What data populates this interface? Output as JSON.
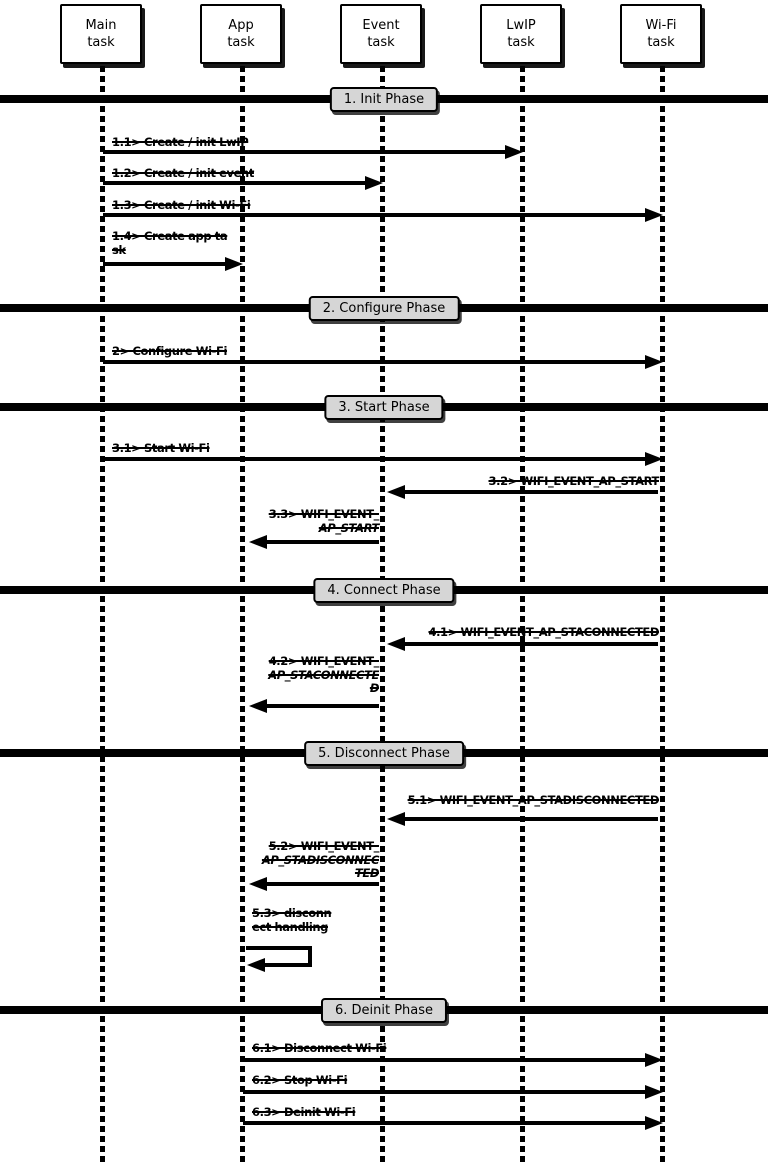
{
  "actors": [
    {
      "line1": "Main",
      "line2": "task"
    },
    {
      "line1": "App",
      "line2": "task"
    },
    {
      "line1": "Event",
      "line2": "task"
    },
    {
      "line1": "LwIP",
      "line2": "task"
    },
    {
      "line1": "Wi-Fi",
      "line2": "task"
    }
  ],
  "phases": [
    {
      "label": "1. Init Phase"
    },
    {
      "label": "2. Configure Phase"
    },
    {
      "label": "3. Start Phase"
    },
    {
      "label": "4. Connect Phase"
    },
    {
      "label": "5. Disconnect Phase"
    },
    {
      "label": "6. Deinit Phase"
    }
  ],
  "messages": [
    {
      "id": "1.1",
      "from": "Main task",
      "to": "LwIP task",
      "lines": [
        "1.1> Create / init LwIP"
      ]
    },
    {
      "id": "1.2",
      "from": "Main task",
      "to": "Event task",
      "lines": [
        "1.2> Create / init event"
      ]
    },
    {
      "id": "1.3",
      "from": "Main task",
      "to": "Wi-Fi task",
      "lines": [
        "1.3> Create / init Wi-Fi"
      ]
    },
    {
      "id": "1.4",
      "from": "Main task",
      "to": "App task",
      "lines": [
        "1.4> Create app ta",
        "sk"
      ]
    },
    {
      "id": "2",
      "from": "Main task",
      "to": "Wi-Fi task",
      "lines": [
        "2> Configure Wi-Fi"
      ]
    },
    {
      "id": "3.1",
      "from": "Main task",
      "to": "Wi-Fi task",
      "lines": [
        "3.1> Start Wi-Fi"
      ]
    },
    {
      "id": "3.2",
      "from": "Wi-Fi task",
      "to": "Event task",
      "lines": [
        "3.2> WIFI_EVENT_AP_START"
      ]
    },
    {
      "id": "3.3",
      "from": "Event task",
      "to": "App task",
      "lines": [
        "3.3> WIFI_EVENT_",
        "AP_START"
      ]
    },
    {
      "id": "4.1",
      "from": "Wi-Fi task",
      "to": "Event task",
      "lines": [
        "4.1> WIFI_EVENT_AP_STACONNECTED"
      ]
    },
    {
      "id": "4.2",
      "from": "Event task",
      "to": "App task",
      "lines": [
        "4.2> WIFI_EVENT_",
        "AP_STACONNECTE",
        "D"
      ]
    },
    {
      "id": "5.1",
      "from": "Wi-Fi task",
      "to": "Event task",
      "lines": [
        "5.1> WIFI_EVENT_AP_STADISCONNECTED"
      ]
    },
    {
      "id": "5.2",
      "from": "Event task",
      "to": "App task",
      "lines": [
        "5.2> WIFI_EVENT_",
        "AP_STADISCONNEC",
        "TED"
      ]
    },
    {
      "id": "5.3",
      "from": "App task",
      "to": "App task",
      "lines": [
        "5.3> disconn",
        "ect handling"
      ]
    },
    {
      "id": "6.1",
      "from": "App task",
      "to": "Wi-Fi task",
      "lines": [
        "6.1> Disconnect Wi-Fi"
      ]
    },
    {
      "id": "6.2",
      "from": "App task",
      "to": "Wi-Fi task",
      "lines": [
        "6.2> Stop Wi-Fi"
      ]
    },
    {
      "id": "6.3",
      "from": "App task",
      "to": "Wi-Fi task",
      "lines": [
        "6.3> Deinit Wi-Fi"
      ]
    }
  ],
  "colors": {
    "background": "#ffffff",
    "line_color": "#000000",
    "phase_label_bg": "#d6d6d6",
    "actor_box_bg": "#ffffff"
  }
}
